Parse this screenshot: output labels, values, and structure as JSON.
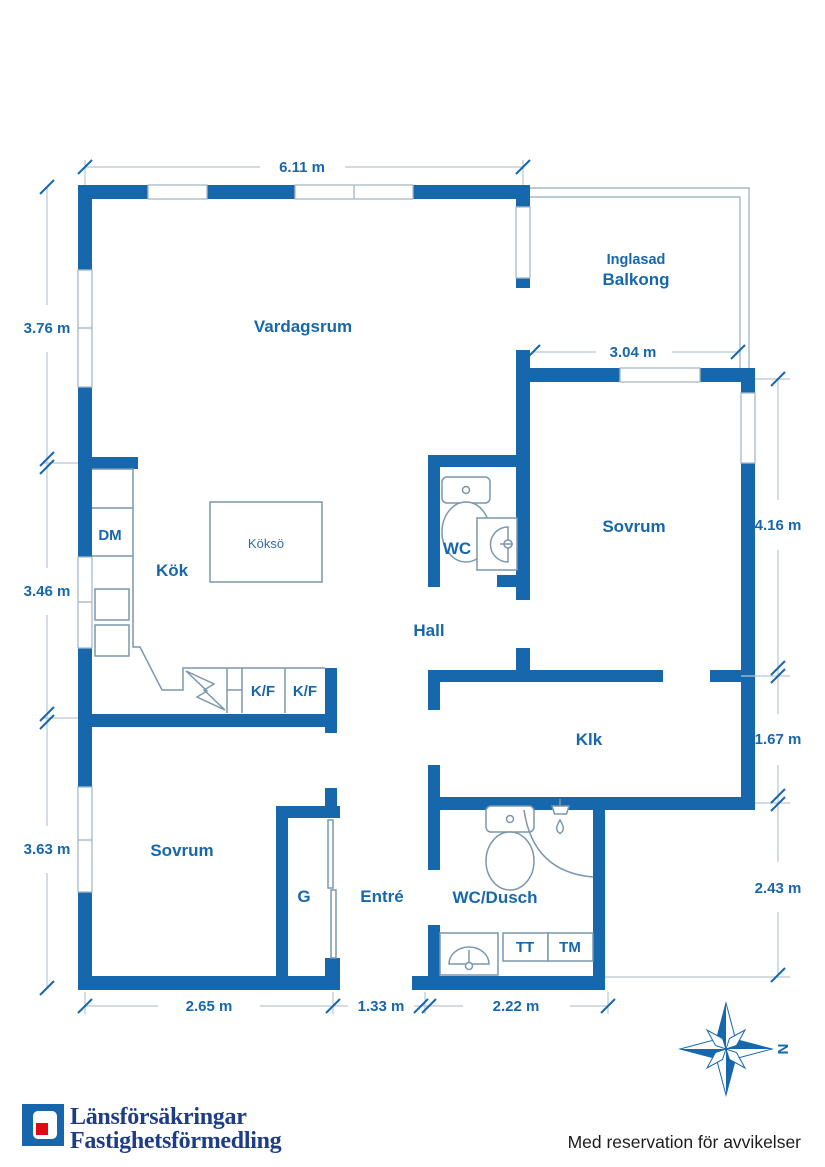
{
  "plan": {
    "labels": {
      "vardagsrum": "Vardagsrum",
      "inglasad": "Inglasad",
      "balkong": "Balkong",
      "kok": "Kök",
      "kokso": "Köksö",
      "dm": "DM",
      "kf1": "K/F",
      "kf2": "K/F",
      "wc": "WC",
      "hall": "Hall",
      "sovrum_right": "Sovrum",
      "klk": "Klk",
      "sovrum_left": "Sovrum",
      "g": "G",
      "entre": "Entré",
      "wc_dusch": "WC/Dusch",
      "tt": "TT",
      "tm": "TM"
    },
    "dimensions": {
      "top": "6.11 m",
      "balcony": "3.04 m",
      "left_top": "3.76 m",
      "left_mid": "3.46 m",
      "left_bottom": "3.63 m",
      "right_top": "4.16 m",
      "right_mid": "1.67 m",
      "right_bottom": "2.43 m",
      "bottom_left": "2.65 m",
      "bottom_mid": "1.33 m",
      "bottom_right": "2.22 m"
    },
    "compass_north": "N",
    "colors": {
      "wall_blue": "#1767AD",
      "brand_navy": "#1D3E86",
      "brand_red": "#E30613"
    }
  },
  "footer": {
    "brand_line1": "Länsförsäkringar",
    "brand_line2": "Fastighetsförmedling",
    "disclaimer": "Med reservation för avvikelser"
  }
}
